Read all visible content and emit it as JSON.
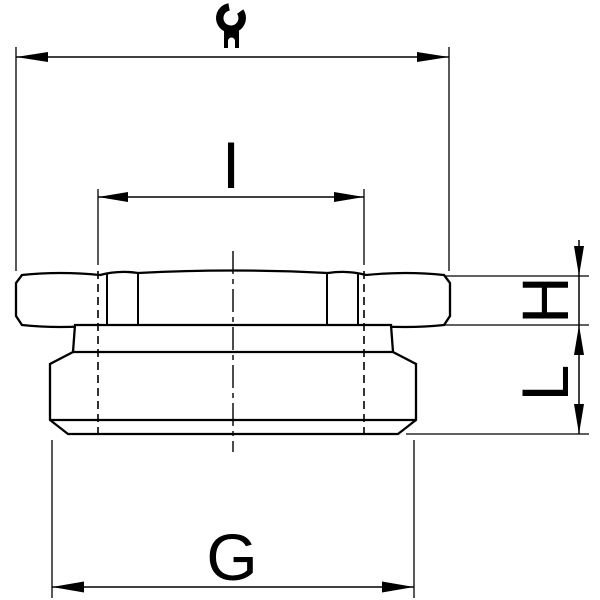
{
  "drawing": {
    "type": "technical-drawing",
    "subject": "cable-gland-reducer-side-view",
    "colors": {
      "background": "#ffffff",
      "line": "#000000"
    },
    "icons": {
      "spanner": "wrench-icon"
    },
    "dimensions": {
      "spanner_width": {
        "label": "",
        "icon": "wrench-icon",
        "position": "top"
      },
      "inner_thread": {
        "label": "I",
        "position": "upper-middle"
      },
      "hex_height": {
        "label": "H",
        "position": "right"
      },
      "body_length": {
        "label": "L",
        "position": "right"
      },
      "outer_thread": {
        "label": "G",
        "position": "bottom"
      }
    }
  }
}
